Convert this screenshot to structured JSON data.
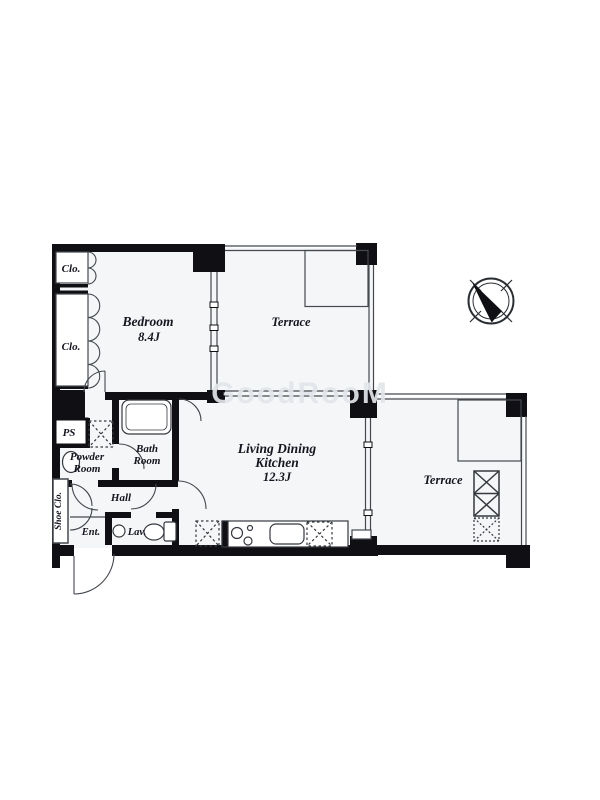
{
  "floorplan": {
    "watermark": "GoodRooM",
    "colors": {
      "wall": "#101014",
      "thin_line": "#44494f",
      "floor": "#f5f6f8",
      "label": "#15151f",
      "watermark": "#e2e5e9"
    },
    "rooms": {
      "closet_top": {
        "label": "Clo."
      },
      "closet_bottom": {
        "label": "Clo."
      },
      "bedroom": {
        "label": "Bedroom",
        "size": "8.4J"
      },
      "terrace_top": {
        "label": "Terrace"
      },
      "terrace_right": {
        "label": "Terrace"
      },
      "ldk": {
        "label_line1": "Living Dining",
        "label_line2": "Kitchen",
        "size": "12.3J"
      },
      "bath": {
        "label_line1": "Bath",
        "label_line2": "Room"
      },
      "powder": {
        "label_line1": "Powder",
        "label_line2": "Room"
      },
      "ps": {
        "label": "PS"
      },
      "hall": {
        "label": "Hall"
      },
      "shoe_closet": {
        "label": "Shoe Clo."
      },
      "entrance": {
        "label": "Ent."
      },
      "lavatory": {
        "label": "Lav."
      }
    }
  }
}
